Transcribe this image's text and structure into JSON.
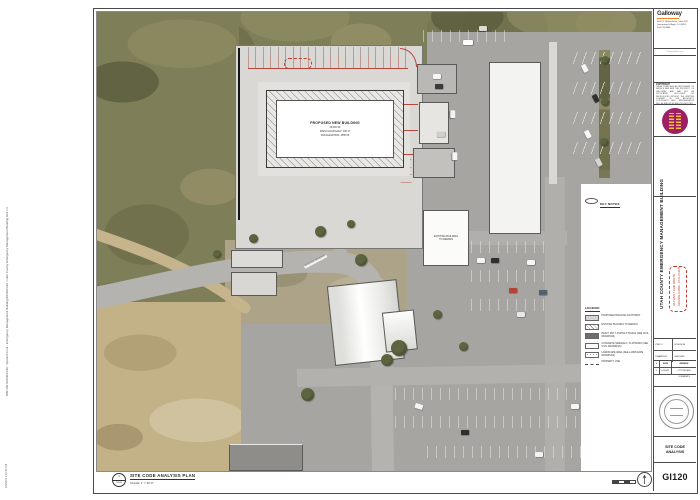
{
  "sheet": {
    "firm": {
      "name": "Galloway",
      "address_lines": [
        "6162 S. Willow Drive, Suite 320",
        "Greenwood Village, CO 80111",
        "303.770.8884"
      ],
      "website": "GallowayUS.com"
    },
    "copyright": {
      "title": "COPYRIGHT:",
      "body": "THESE PLANS ARE AN INSTRUMENT OF SERVICE AND ARE THE PROPERTY OF GALLOWAY, AND MAY NOT BE DUPLICATED, DISCLOSED OR REPRODUCED WITHOUT THE WRITTEN CONSENT OF THE ARCHITECT. COPYRIGHTS AND INFRINGEMENTS WILL BE ENFORCED AND PROSECUTED."
    },
    "project": {
      "title": "UTAH COUNTY EMERGENCY MANAGEMENT BUILDING",
      "address_line1": "364 WEST 3200 NORTH",
      "address_line2": "SPANISH FORK, UTAH 84660"
    },
    "info": {
      "proj_label": "PROJ #",
      "proj_value": "DC0024.90",
      "drawn_label": "DRAWN BY",
      "checked_label": "CHECKED"
    },
    "revisions": {
      "headers": [
        "#",
        "DATE",
        "REMARK"
      ],
      "rows": [
        [
          "1",
          "01/05/21",
          "CITY REVIEW COMMENTS"
        ]
      ]
    },
    "sheet_title": "SITE CODE ANALYSIS",
    "sheet_number": "GI120",
    "edge_text": "BIM 360://DC0024.90 - Spanish Fork - Emergency Management Building/DC0024.90 - Utah County Emergency Management Building R21.rvt",
    "plot_stamp": "1/5/2021 2:41:32 PM"
  },
  "view": {
    "title": "SITE CODE ANALYSIS PLAN",
    "scale": "SCALE: 1\" = 30'-0\"",
    "marker_number": "1"
  },
  "plan": {
    "building_label": {
      "line1": "PROPOSED NEW BUILDING",
      "line2": "30,000 SF",
      "line3": "MAIN FLOOR ELEV: 100'-0\"",
      "line4": "PAD ELEVATION: 4555.50"
    },
    "existing_building_label": {
      "line1": "EXISTING BUILDING",
      "line2": "TO REMAIN"
    },
    "driveway_label": "EXISTING DRIVEWAY",
    "key_notes_title": "KEY NOTES",
    "legend": {
      "title": "LEGEND:",
      "items": [
        {
          "label": "PROPOSED BUILDING FOOTPRINT"
        },
        {
          "label": "EXISTING BUILDING TO REMAIN"
        },
        {
          "label": "HEAVY DUTY ASPHALT PAVING (SEE CIVIL DRAWINGS)"
        },
        {
          "label": "CONCRETE SIDEWALK / FLATWORK (SEE CIVIL DRAWINGS)"
        },
        {
          "label": "LANDSCAPE AREA (SEE LANDSCAPE DRAWINGS)"
        },
        {
          "label": "PROPERTY LINE"
        }
      ]
    }
  },
  "colors": {
    "accent_orange": "#F5821F",
    "emblem_magenta": "#9E1F63",
    "annotation_red": "#B5473C",
    "title_red": "#C0392B"
  }
}
